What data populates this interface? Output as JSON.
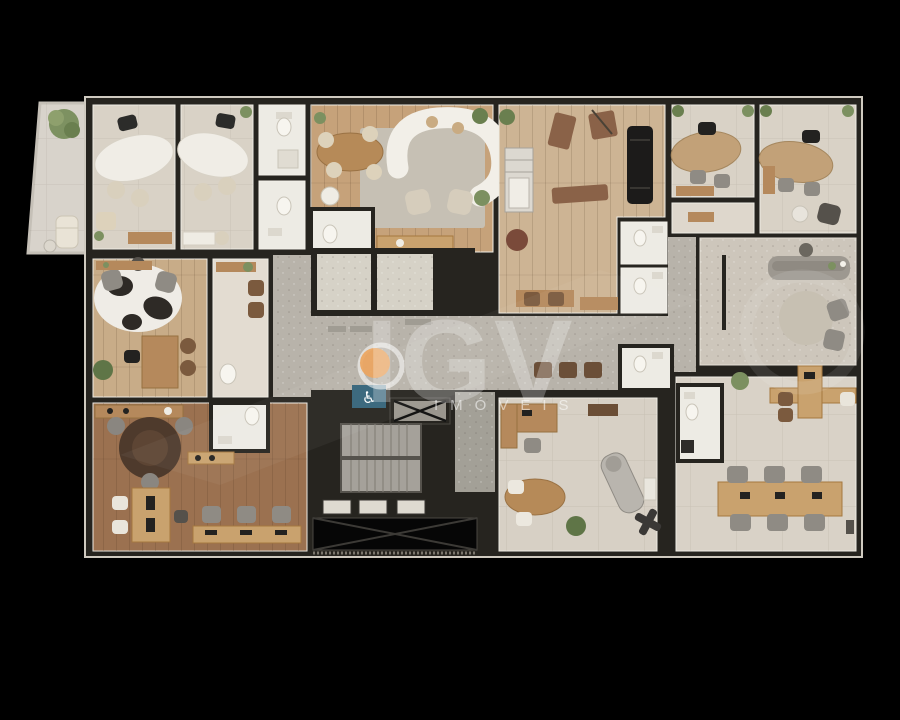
{
  "watermark": {
    "brand": "IGV",
    "subtitle": "IMÓVEIS"
  },
  "icons": {
    "wheelchair": "♿"
  },
  "colors": {
    "background": "#000000",
    "brand_orange": "#eca55f",
    "accessible_sign_blue": "#35647a",
    "wall_dark": "#26241f",
    "floor_cream": "#d9d2c6",
    "floor_white": "#edebe4",
    "floor_wood_lounge": "#c6a27a",
    "floor_wood_gym": "#cdb494",
    "floor_wood_tan": "#c8ac88",
    "floor_wood_dark": "#9b7150",
    "floor_corridor_gray": "#b8b3aa",
    "floor_reception": "#cdc6bb",
    "terrace_tile": "#d8d3cb"
  }
}
